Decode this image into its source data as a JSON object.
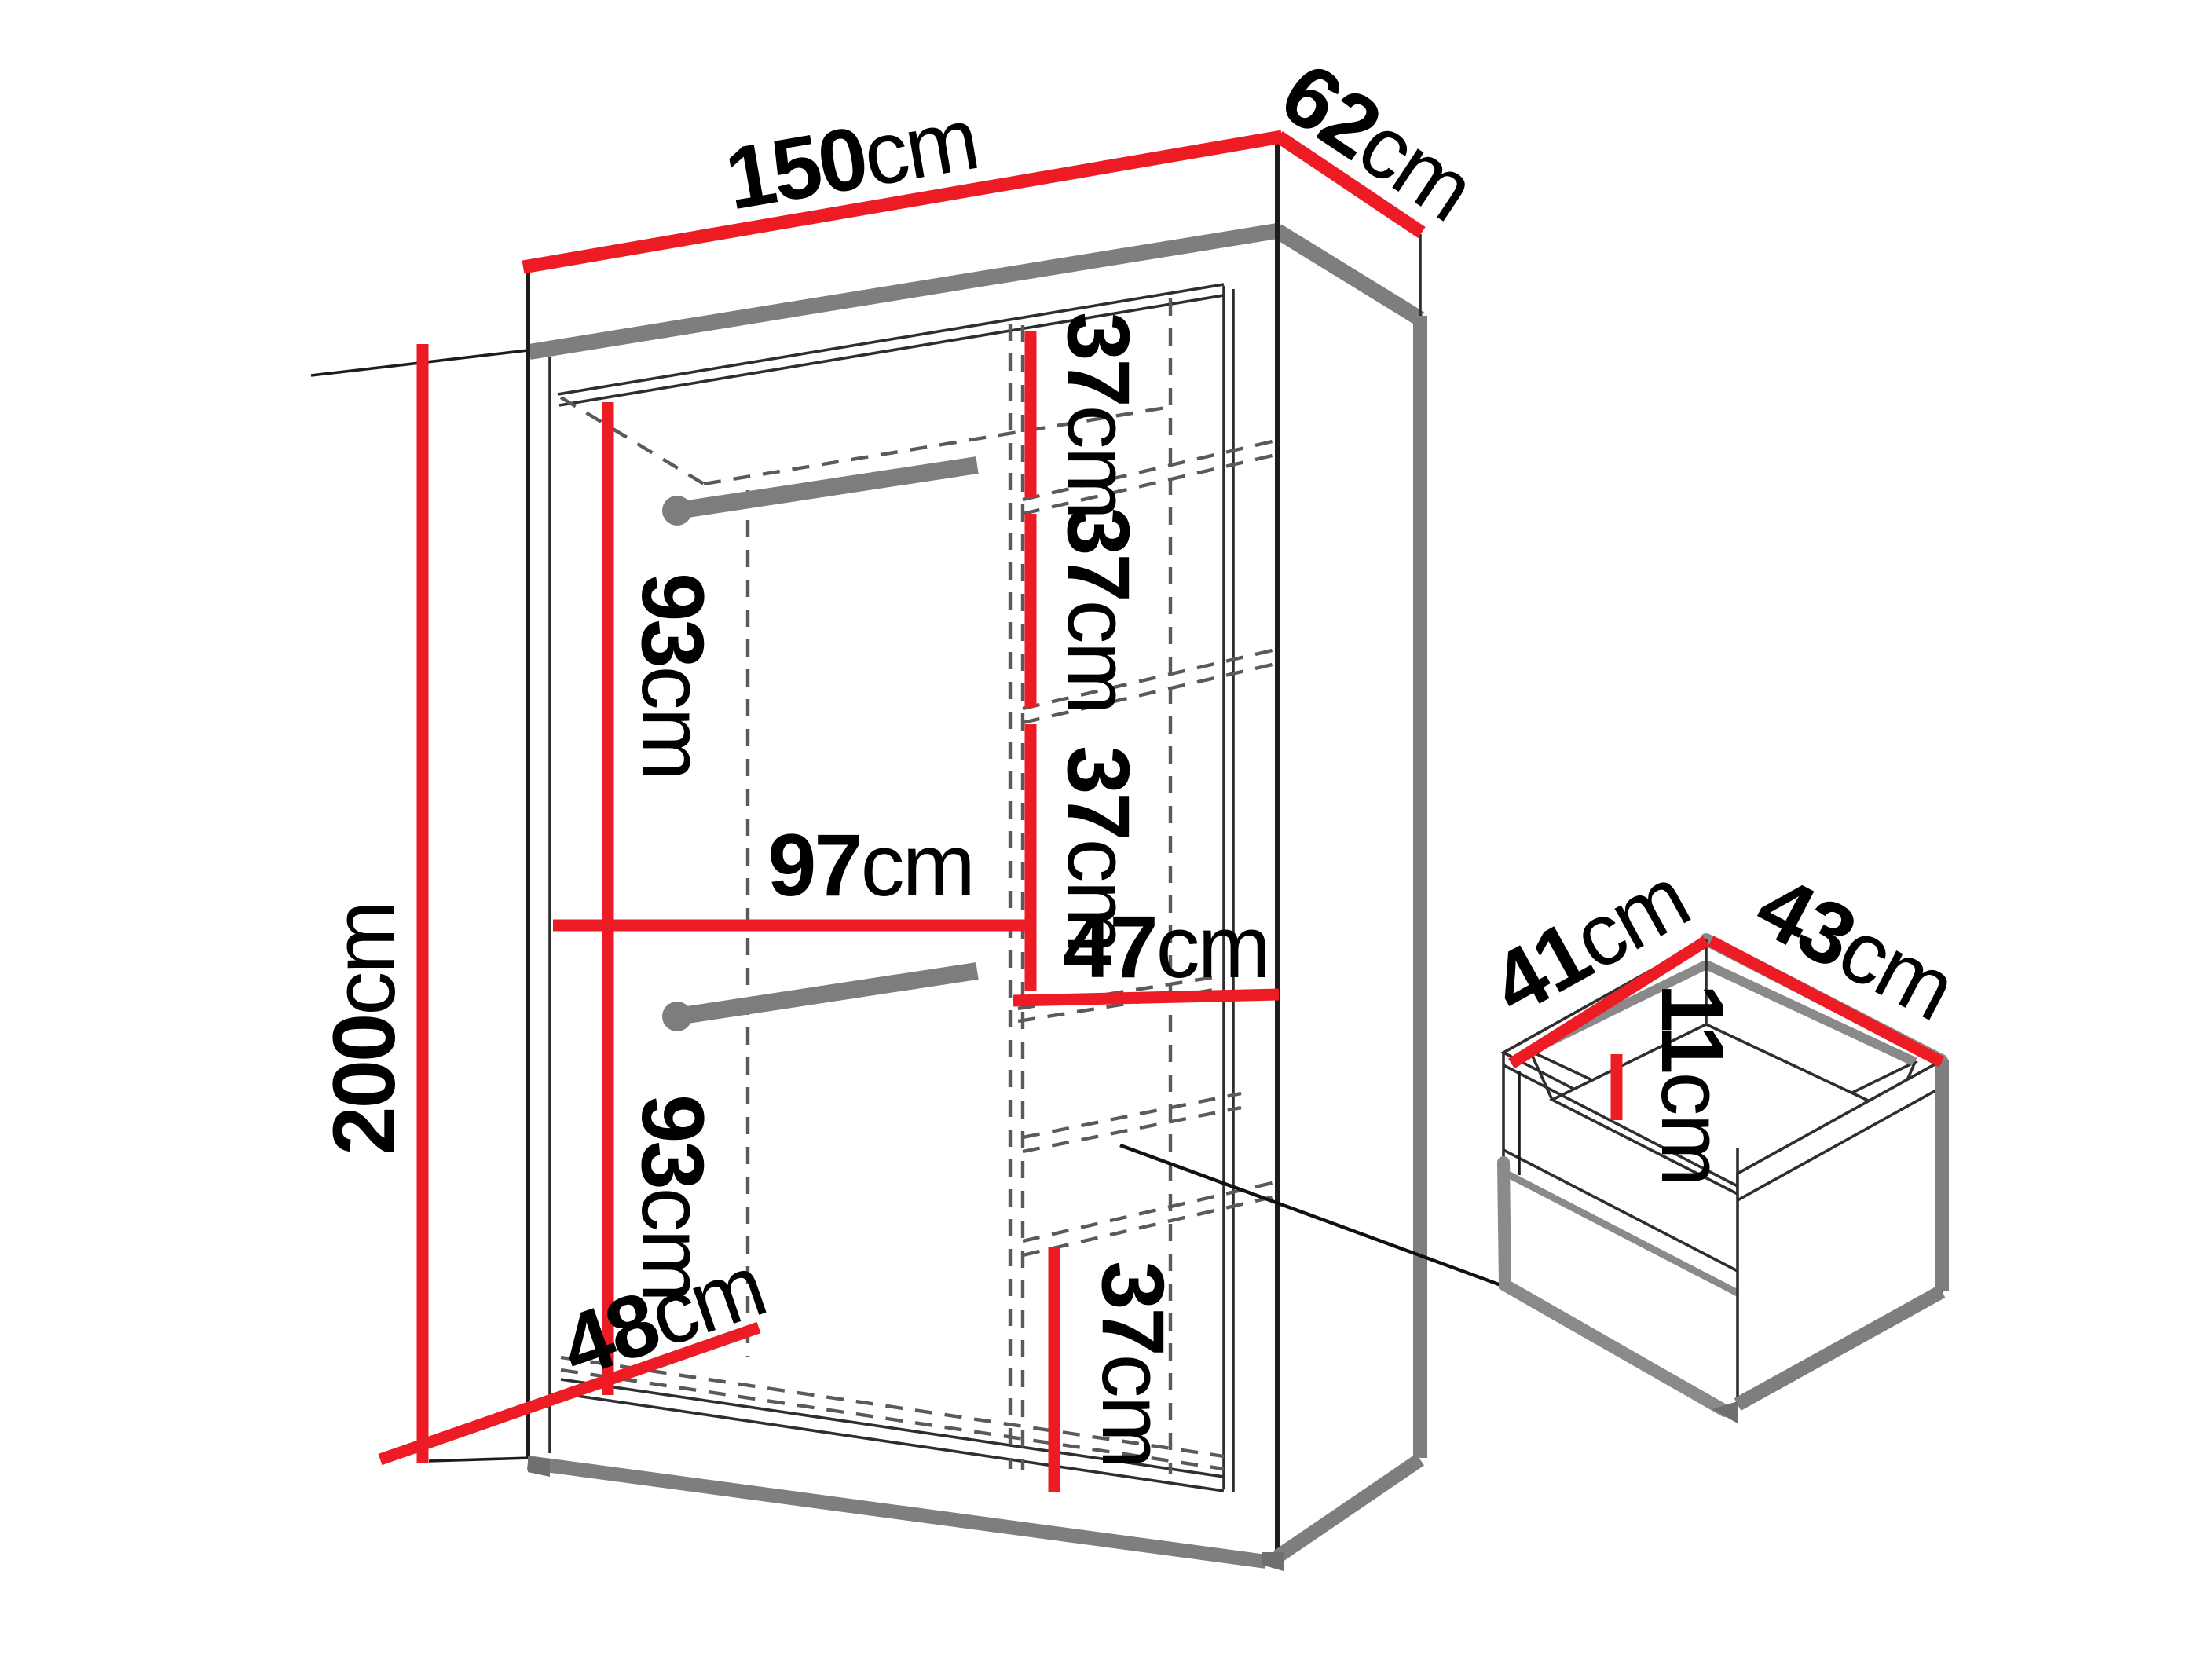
{
  "meta": {
    "diagram_type": "furniture-dimension-diagram",
    "subject": "two-door wardrobe with interior shelves, hanging rods and drawer",
    "unit": "cm",
    "colors": {
      "dimension_line": "#ed1c24",
      "outline": "#2e2e2e",
      "shadow_edge": "#7e7e7e",
      "background": "#ffffff",
      "text": "#000000"
    }
  },
  "labels": {
    "w150": {
      "num": "150",
      "unit": "cm"
    },
    "d62": {
      "num": "62",
      "unit": "cm"
    },
    "h200": {
      "num": "200",
      "unit": "cm"
    },
    "h93top": {
      "num": "93",
      "unit": "cm"
    },
    "w97": {
      "num": "97",
      "unit": "cm"
    },
    "h93bottom": {
      "num": "93",
      "unit": "cm"
    },
    "d48": {
      "num": "48",
      "unit": "cm"
    },
    "shelf37_1": {
      "num": "37",
      "unit": "cm"
    },
    "shelf37_2": {
      "num": "37",
      "unit": "cm"
    },
    "shelf37_3": {
      "num": "37",
      "unit": "cm"
    },
    "w47": {
      "num": "47",
      "unit": "cm"
    },
    "shelf37_bottom": {
      "num": "37",
      "unit": "cm"
    },
    "drawer_d41": {
      "num": "41",
      "unit": "cm"
    },
    "drawer_w43": {
      "num": "43",
      "unit": "cm"
    },
    "drawer_h11": {
      "num": "11",
      "unit": "cm"
    }
  }
}
